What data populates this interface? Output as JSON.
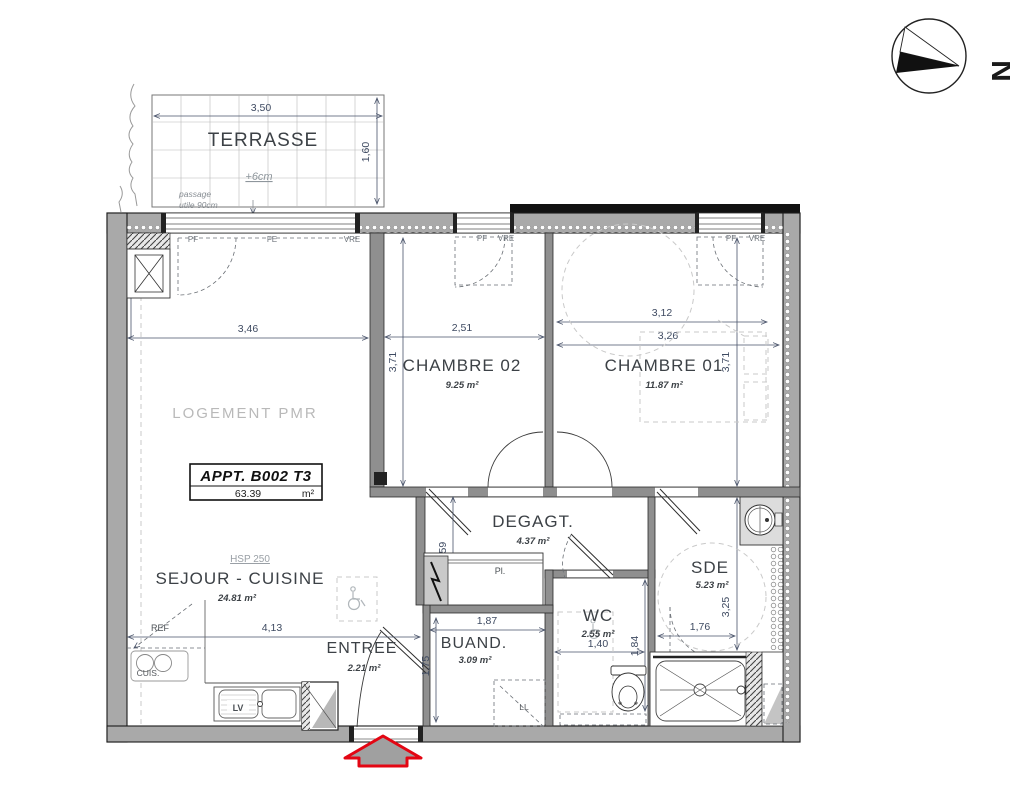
{
  "colors": {
    "accent_red": "#e30613",
    "wall_gray": "#a9a9a9",
    "dim_text": "#3e4a61",
    "light_gray_text": "#b9b9b9"
  },
  "north": {
    "label": "N"
  },
  "terrace": {
    "name": "TERRASSE",
    "dim_width": "3,50",
    "dim_height": "1,60",
    "level_note": "+6cm",
    "passage_1": "passage",
    "passage_2": "utile 90cm",
    "window_labels": [
      "PF",
      "FE",
      "VRE"
    ]
  },
  "unit": {
    "type_label": "LOGEMENT PMR",
    "title": "APPT. B002 T3",
    "area": "63.39",
    "area_unit": "m²"
  },
  "rooms": {
    "sejour": {
      "hsp": "HSP 250",
      "name": "SEJOUR - CUISINE",
      "area": "24.81  m²",
      "dim_width": "3,46",
      "dim_kitchen": "4,13"
    },
    "chambre02": {
      "name": "CHAMBRE 02",
      "area": "9.25  m²",
      "dim_width": "2,51",
      "dim_height": "3,71",
      "window_labels": [
        "PF",
        "VRE"
      ]
    },
    "chambre01": {
      "name": "CHAMBRE 01",
      "area": "11.87  m²",
      "dim_width_a": "3,12",
      "dim_width_b": "3,26",
      "dim_height": "3,71",
      "window_labels": [
        "PF",
        "VRE"
      ]
    },
    "degagement": {
      "name": "DEGAGT.",
      "area": "4.37  m²",
      "dim_height": "1,59",
      "placard": "Pl."
    },
    "wc": {
      "name": "WC",
      "area": "2.55  m²",
      "dim_width": "1,40",
      "dim_height": "1,84"
    },
    "sde": {
      "name": "SDE",
      "area": "5.23  m²",
      "dim_height": "3,25",
      "dim_width": "1,76"
    },
    "buanderie": {
      "name": "BUAND.",
      "area": "3.09  m²",
      "dim_width": "1,87",
      "dim_height": "1,75",
      "appliance": "LL"
    },
    "entree": {
      "name": "ENTREE",
      "area": "2.21  m²"
    }
  },
  "kitchen": {
    "fridge": "REF",
    "cooktop": "CUIS.",
    "dishwasher": "LV"
  }
}
